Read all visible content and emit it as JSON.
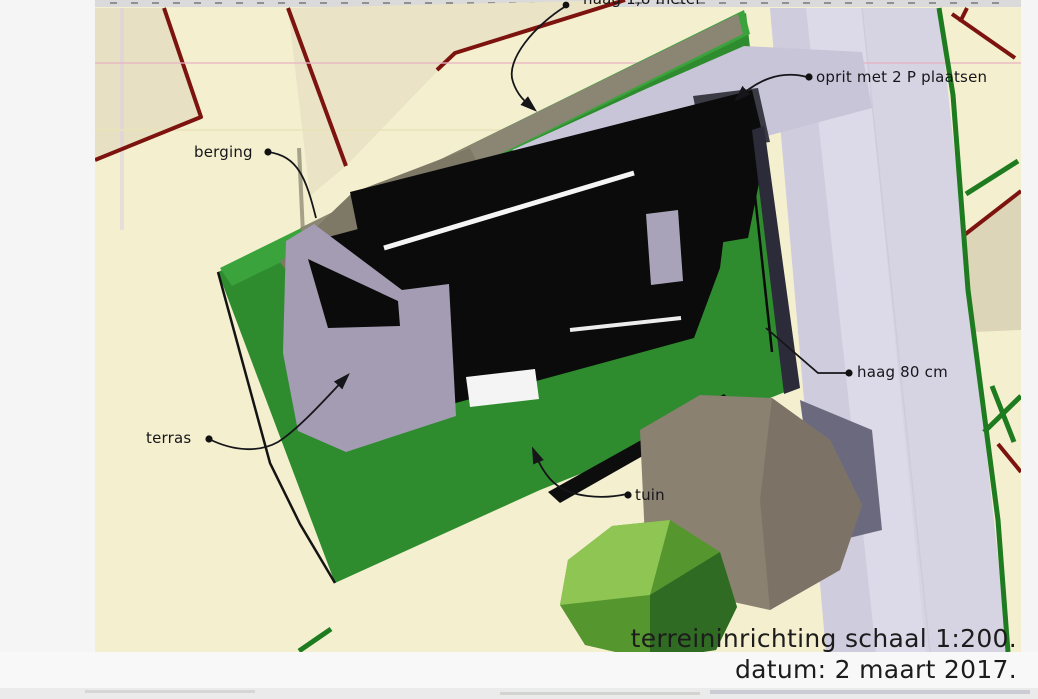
{
  "document": {
    "annotations": {
      "haag18": {
        "label": "haag 1,8 meter"
      },
      "oprit": {
        "label": "oprit met 2 P plaatsen"
      },
      "berging": {
        "label": "berging"
      },
      "haag80": {
        "label": "haag 80 cm"
      },
      "terras": {
        "label": "terras"
      },
      "tuin": {
        "label": "tuin"
      }
    },
    "title_block": {
      "scale_line": "terreininrichting schaal 1:200.",
      "date_line": "datum: 2 maart 2017."
    },
    "colors": {
      "parcel_background": "#f4f0cf",
      "parcel_shaded": "#e7e0c2",
      "boundary_red": "#7c130e",
      "boundary_green": "#1e7b20",
      "road_lavender": "#d6d3e3",
      "driveway_lavender": "#c9c5d9",
      "garden_green": "#2e8c2f",
      "hedge_green": "#3ba33c",
      "roof_black": "#0b0b0b",
      "terrace_lavender": "#a49cb3",
      "shed_roof_gray": "#7e7967",
      "tree_taupe": "#8b8171",
      "tree_green_light": "#8fc653",
      "tree_green_dark": "#2f6b22"
    }
  }
}
